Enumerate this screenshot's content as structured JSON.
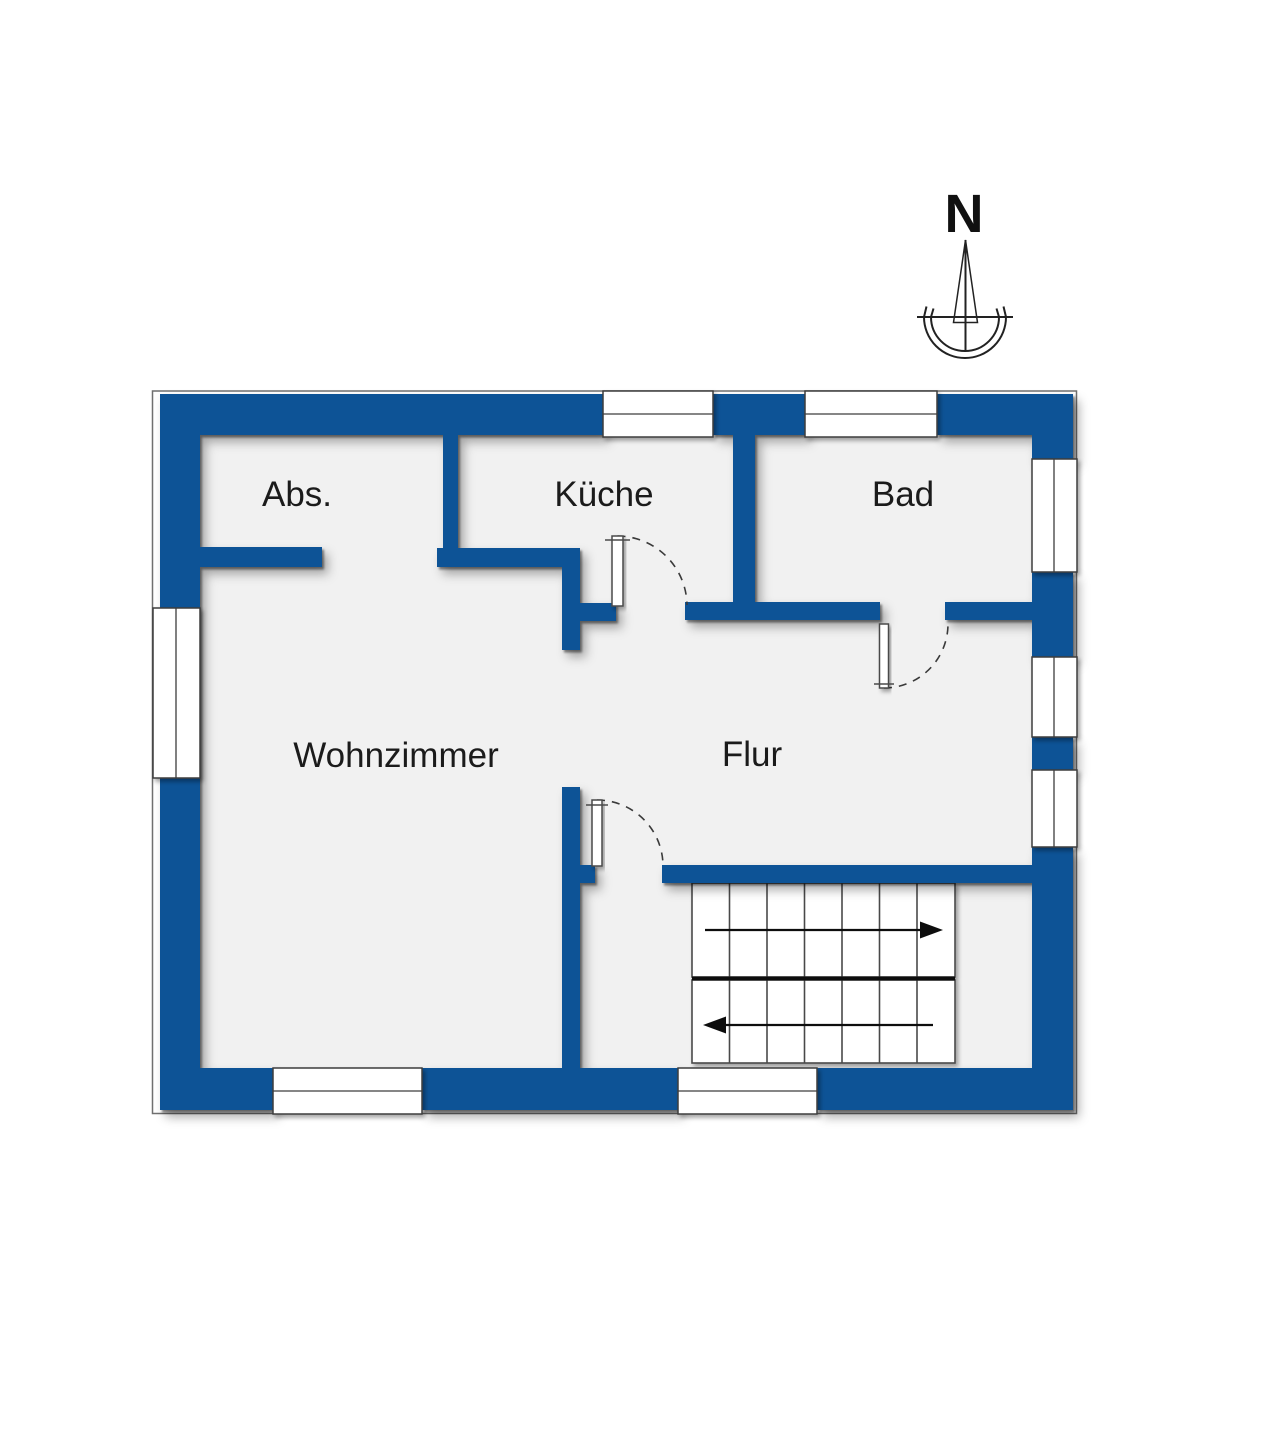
{
  "colors": {
    "wall_blue": "#0e5296",
    "floor_gray": "#f1f1f1"
  },
  "compass": {
    "label": "N"
  },
  "rooms": [
    {
      "id": "abs",
      "label": "Abs."
    },
    {
      "id": "kueche",
      "label": "Küche"
    },
    {
      "id": "bad",
      "label": "Bad"
    },
    {
      "id": "wohnzimmer",
      "label": "Wohnzimmer"
    },
    {
      "id": "flur",
      "label": "Flur"
    }
  ],
  "stairs": {
    "flights": 2,
    "treads_per_flight": 7,
    "upper_flight_arrow_direction": "right",
    "lower_flight_arrow_direction": "left"
  },
  "openings": {
    "windows_top": 2,
    "windows_right": 3,
    "windows_left": 1,
    "windows_bottom": 2,
    "doors": 3
  }
}
